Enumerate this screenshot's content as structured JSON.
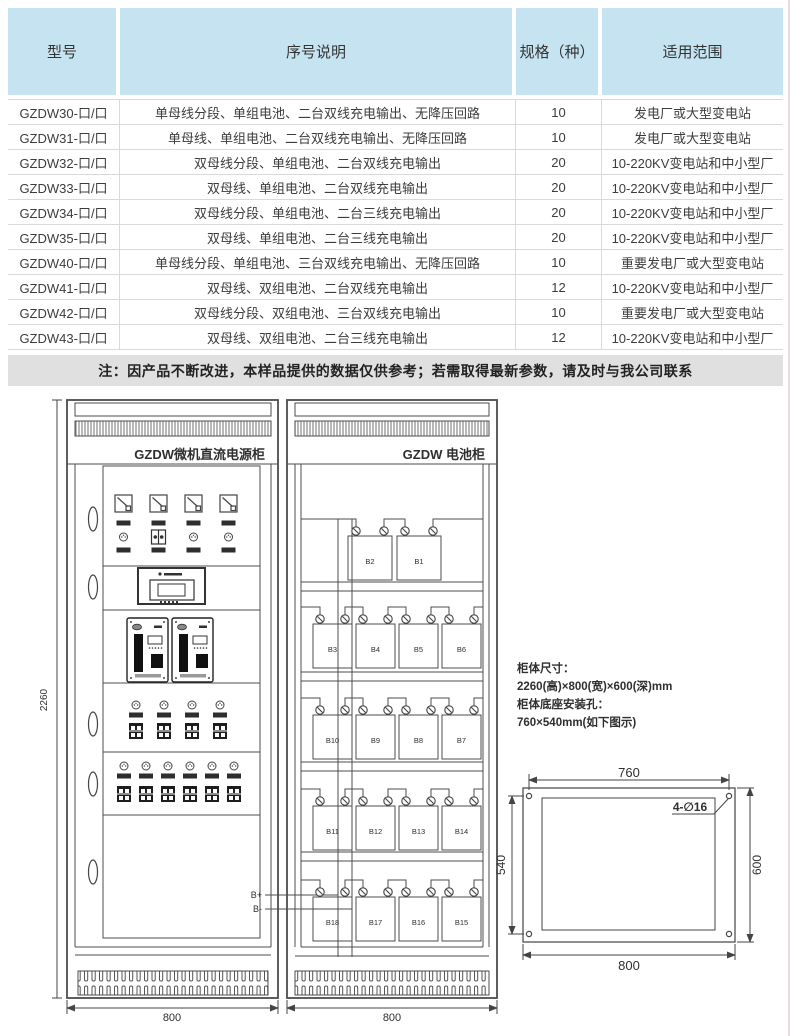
{
  "colors": {
    "header_bg": "#c6e3f2",
    "note_bg": "#e0e0e0",
    "line": "#555555"
  },
  "table": {
    "headers": [
      "型号",
      "序号说明",
      "规格（种）",
      "适用范围"
    ],
    "rows": [
      {
        "model": "GZDW30-口/口",
        "desc": "单母线分段、单组电池、二台双线充电输出、无降压回路",
        "spec": "10",
        "range": "发电厂或大型变电站"
      },
      {
        "model": "GZDW31-口/口",
        "desc": "单母线、单组电池、二台双线充电输出、无降压回路",
        "spec": "10",
        "range": "发电厂或大型变电站"
      },
      {
        "model": "GZDW32-口/口",
        "desc": "双母线分段、单组电池、二台双线充电输出",
        "spec": "20",
        "range": "10-220KV变电站和中小型厂"
      },
      {
        "model": "GZDW33-口/口",
        "desc": "双母线、单组电池、二台双线充电输出",
        "spec": "20",
        "range": "10-220KV变电站和中小型厂"
      },
      {
        "model": "GZDW34-口/口",
        "desc": "双母线分段、单组电池、二台三线充电输出",
        "spec": "20",
        "range": "10-220KV变电站和中小型厂"
      },
      {
        "model": "GZDW35-口/口",
        "desc": "双母线、单组电池、二台三线充电输出",
        "spec": "20",
        "range": "10-220KV变电站和中小型厂"
      },
      {
        "model": "GZDW40-口/口",
        "desc": "单母线分段、单组电池、三台双线充电输出、无降压回路",
        "spec": "10",
        "range": "重要发电厂或大型变电站"
      },
      {
        "model": "GZDW41-口/口",
        "desc": "双母线、双组电池、二台双线充电输出",
        "spec": "12",
        "range": "10-220KV变电站和中小型厂"
      },
      {
        "model": "GZDW42-口/口",
        "desc": "双母线分段、双组电池、三台双线充电输出",
        "spec": "10",
        "range": "重要发电厂或大型变电站"
      },
      {
        "model": "GZDW43-口/口",
        "desc": "双母线、双组电池、二台三线充电输出",
        "spec": "12",
        "range": "10-220KV变电站和中小型厂"
      }
    ],
    "note": "注：因产品不断改进，本样品提供的数据仅供参考；若需取得最新参数，请及时与我公司联系"
  },
  "diagram": {
    "power_cabinet": {
      "title": "GZDW微机直流电源柜",
      "terminal_pos": "B+",
      "terminal_neg": "B-",
      "width_label": "800"
    },
    "battery_cabinet": {
      "title": "GZDW 电池柜",
      "width_label": "800",
      "shelves": [
        [
          "B2",
          "B1"
        ],
        [
          "B3",
          "B4",
          "B5",
          "B6"
        ],
        [
          "B10",
          "B9",
          "B8",
          "B7"
        ],
        [
          "B11",
          "B12",
          "B13",
          "B14"
        ],
        [
          "B18",
          "B17",
          "B16",
          "B15"
        ]
      ]
    },
    "height_label": "2260",
    "specs": {
      "line1": "柜体尺寸：",
      "line2": "2260(高)×800(宽)×600(深)mm",
      "line3": "柜体底座安装孔：",
      "line4": "760×540mm(如下图示)"
    },
    "mount": {
      "top": "760",
      "left": "540",
      "right": "600",
      "bottom": "800",
      "holes": "4-∅16"
    }
  }
}
